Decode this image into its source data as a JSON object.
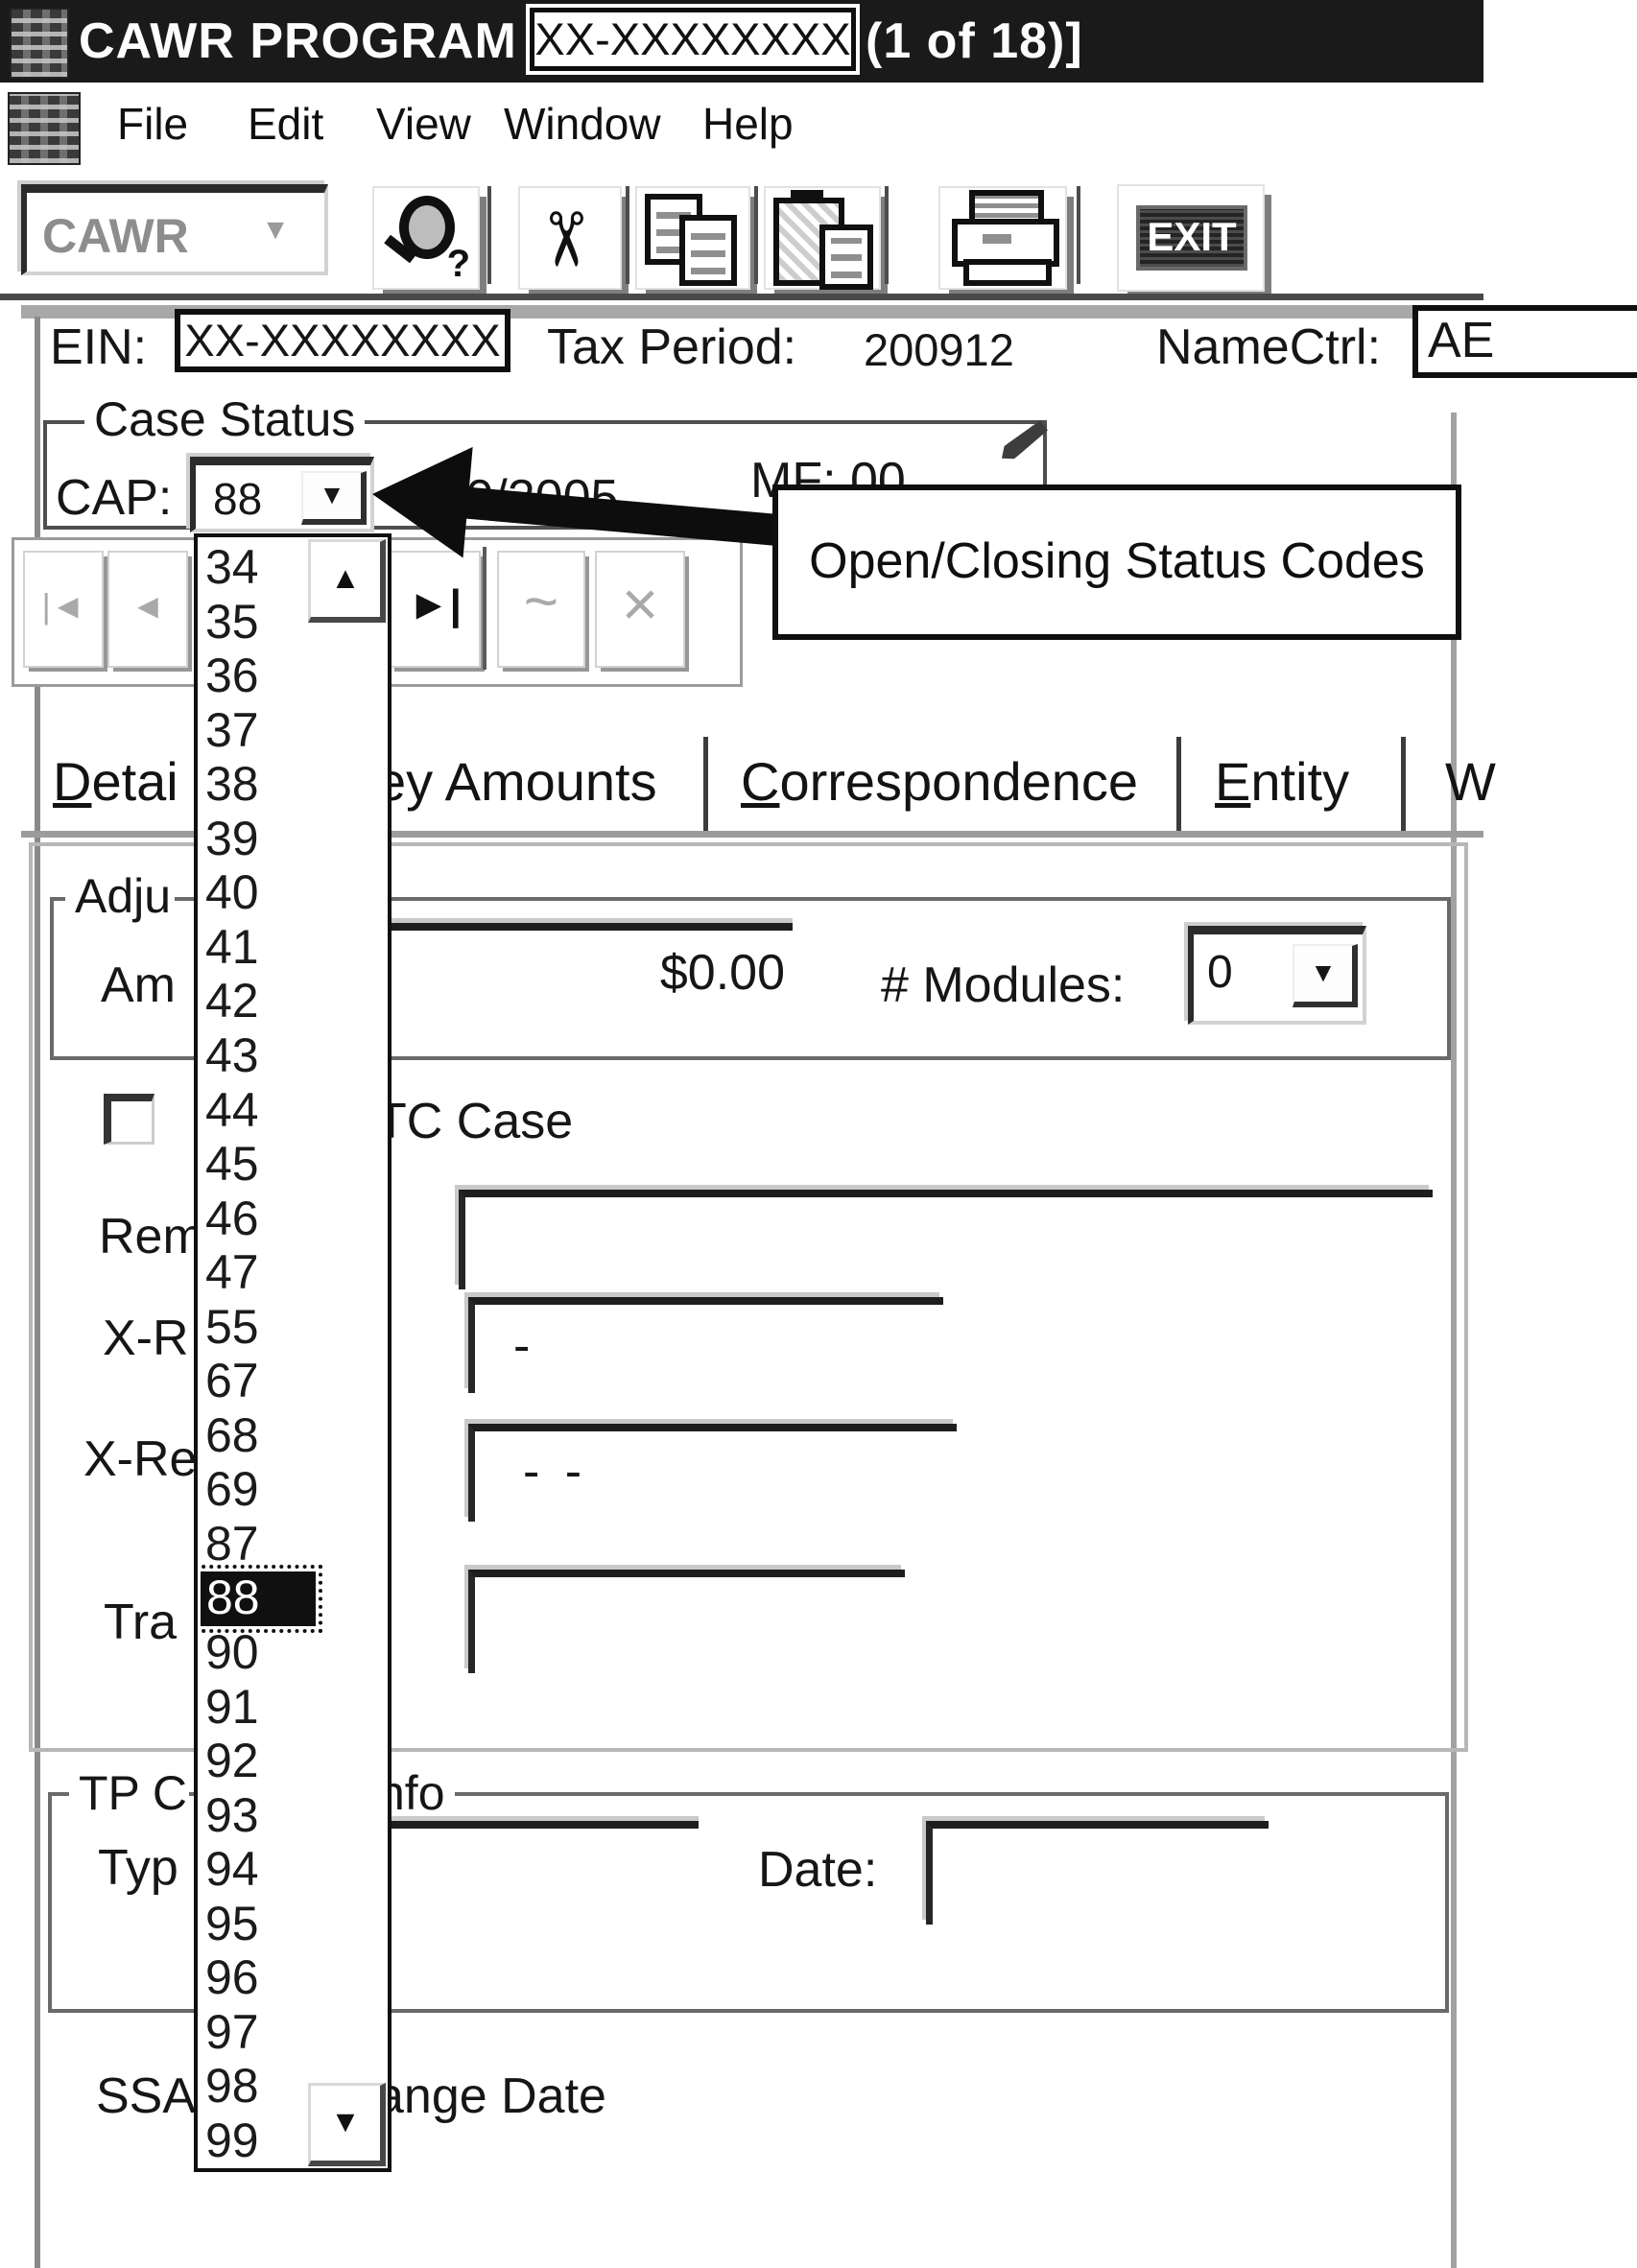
{
  "window": {
    "title_prefix": "CAWR PROGRAM - [",
    "title_redacted": "XX-XXXXXXXX",
    "title_suffix": "(1 of 18)]"
  },
  "menu": {
    "items": [
      "File",
      "Edit",
      "View",
      "Window",
      "Help"
    ]
  },
  "toolbar": {
    "context_combo_value": "CAWR",
    "exit_label": "EXIT"
  },
  "header": {
    "ein_label": "EIN:",
    "ein_value": "XX-XXXXXXXX",
    "tax_period_label": "Tax Period:",
    "tax_period_value": "200912",
    "namectrl_label": "NameCtrl:",
    "namectrl_value": "AE"
  },
  "case_status": {
    "group_label": "Case Status",
    "cap_label": "CAP:",
    "cap_value": "88",
    "date_partial": "/20/2005",
    "mf_partial": "MF: 00"
  },
  "annotation": {
    "callout_text": "Open/Closing Status Codes"
  },
  "status_dropdown": {
    "items": [
      "34",
      "35",
      "36",
      "37",
      "38",
      "39",
      "40",
      "41",
      "42",
      "43",
      "44",
      "45",
      "46",
      "47",
      "55",
      "67",
      "68",
      "69",
      "87",
      "88",
      "90",
      "91",
      "92",
      "93",
      "94",
      "95",
      "96",
      "97",
      "98",
      "99"
    ],
    "selected": "88"
  },
  "tabs": {
    "detail_partial": "Detai",
    "money_amounts_partial": "ey Amounts",
    "correspondence": "Correspondence",
    "entity": "Entity",
    "worksheet_partial": "W"
  },
  "detail_panel": {
    "adjustments_group_partial": "Adju",
    "amount_label_partial": "Am",
    "amount_value": "$0.00",
    "modules_label": "# Modules:",
    "modules_value": "0",
    "tc_case_label_partial": "TC Case",
    "remarks_label_partial": "Rem",
    "xref1_label_partial": "X-R",
    "xref1_value": "-",
    "xref2_label_partial": "X-Re",
    "xref2_value": "- -",
    "trans_label_partial": "Tra"
  },
  "tp_panel": {
    "group_label_left_partial": "TP C",
    "group_label_right_partial": "nfo",
    "type_label_partial": "Typ",
    "date_label": "Date:"
  },
  "footer": {
    "ssa_label_partial": "SSA",
    "change_date_partial": "ange Date"
  },
  "icons": {
    "up": "▲",
    "down": "▼",
    "cut": "✂",
    "next": "►",
    "bar": "|",
    "first": "|◄",
    "prev": "◄",
    "wave": "~",
    "cross": "×",
    "question": "?"
  },
  "colors": {
    "titlebar": "#1a1a1a",
    "ink": "#111111",
    "muted": "#9a9a9a",
    "border_dark": "#333333",
    "border_light": "#c8c8c8"
  }
}
